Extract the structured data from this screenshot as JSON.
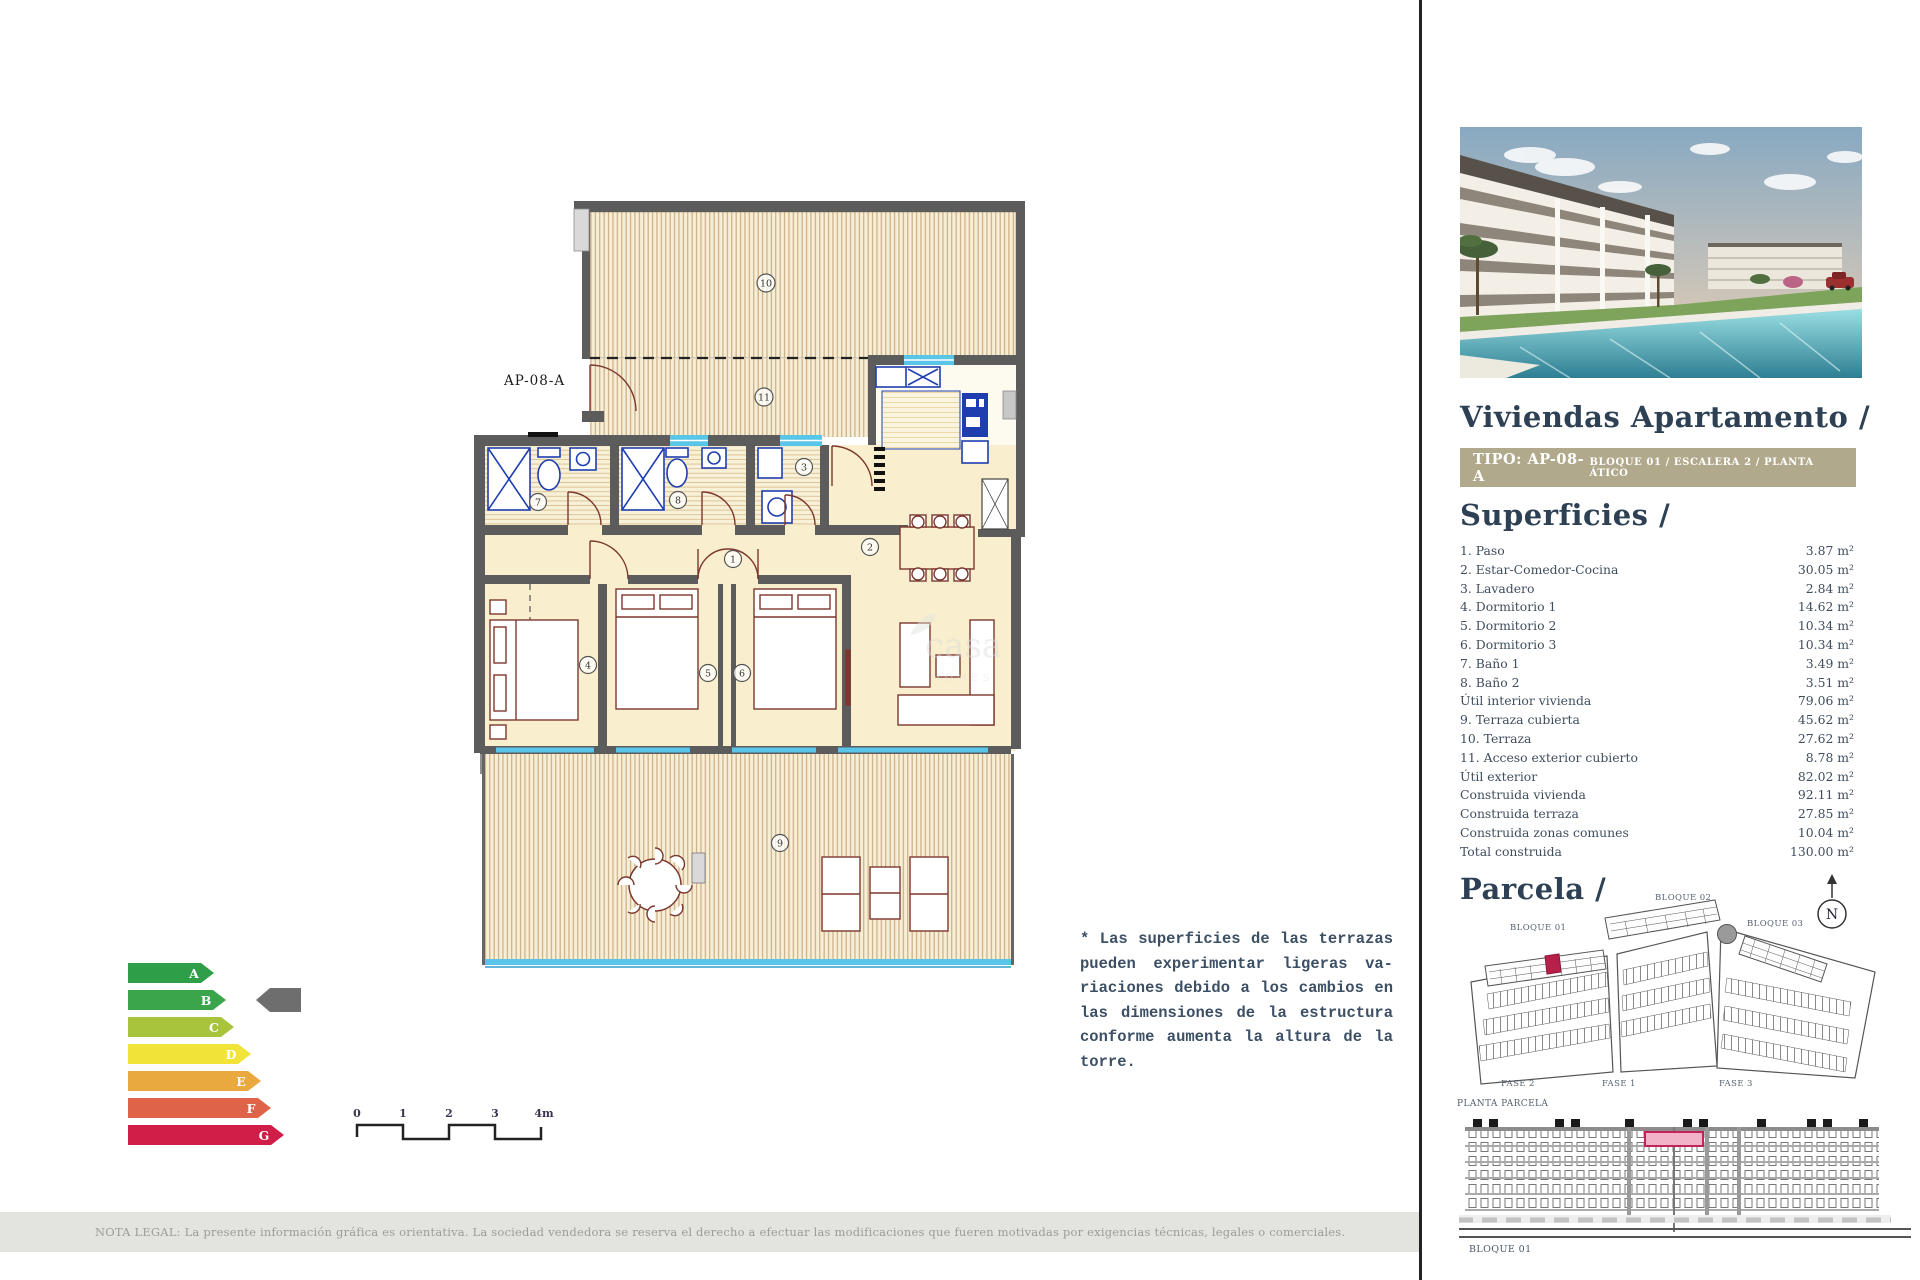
{
  "plan": {
    "unit_label": "AP-08-A",
    "numbers": [
      "1",
      "2",
      "3",
      "4",
      "5",
      "6",
      "7",
      "8",
      "9",
      "10",
      "11"
    ],
    "watermark": {
      "line1": "casa",
      "line2": "HOMES"
    }
  },
  "energy": {
    "grades": [
      "A",
      "B",
      "C",
      "D",
      "E",
      "F",
      "G"
    ],
    "colors": [
      "#2f9e48",
      "#3aa54b",
      "#a8c43c",
      "#f1e338",
      "#eaa93f",
      "#de6349",
      "#d01e48"
    ],
    "active_grade": "B",
    "indicator_color": "#6e6e6e"
  },
  "scalebar": {
    "ticks": [
      "0",
      "1",
      "2",
      "3",
      "4m"
    ]
  },
  "note": {
    "lines": [
      "* Las superficies de las terrazas",
      "pueden experimentar ligeras va-",
      "riaciones debido a los cambios en",
      "las dimensiones de la estructura",
      "conforme aumenta la altura de la",
      "torre."
    ]
  },
  "legal": {
    "text": "NOTA LEGAL: La presente información gráfica es orientativa. La sociedad vendedora se reserva el derecho a efectuar las modificaciones que fueren motivadas por exigencias técnicas, legales o comerciales."
  },
  "panel": {
    "title": "Viviendas Apartamento /",
    "banner": {
      "type": "TIPO: AP-08-A",
      "location": "BLOQUE 01  / ESCALERA 2 / PLANTA ÁTICO"
    },
    "superficies": {
      "title": "Superficies /",
      "rows": [
        {
          "label": "1. Paso",
          "value": "3.87 m²"
        },
        {
          "label": "2. Estar-Comedor-Cocina",
          "value": "30.05 m²"
        },
        {
          "label": "3. Lavadero",
          "value": "2.84 m²"
        },
        {
          "label": "4. Dormitorio 1",
          "value": "14.62 m²"
        },
        {
          "label": "5. Dormitorio 2",
          "value": "10.34 m²"
        },
        {
          "label": "6. Dormitorio 3",
          "value": "10.34 m²"
        },
        {
          "label": "7. Baño 1",
          "value": "3.49 m²"
        },
        {
          "label": "8. Baño 2",
          "value": "3.51 m²"
        },
        {
          "label": "Útil interior vivienda",
          "value": "79.06 m²"
        },
        {
          "label": "9. Terraza cubierta",
          "value": "45.62 m²"
        },
        {
          "label": "10. Terraza",
          "value": "27.62 m²"
        },
        {
          "label": "11. Acceso exterior cubierto",
          "value": "8.78 m²"
        },
        {
          "label": "Útil exterior",
          "value": "82.02 m²"
        },
        {
          "label": "Construida vivienda",
          "value": "92.11 m²"
        },
        {
          "label": "Construida terraza",
          "value": "27.85 m²"
        },
        {
          "label": "Construida zonas comunes",
          "value": "10.04 m²"
        },
        {
          "label": "Total construida",
          "value": "130.00 m²"
        }
      ]
    },
    "parcela": {
      "title": "Parcela /",
      "bloque1": "BLOQUE 01",
      "bloque2": "BLOQUE 02",
      "bloque3": "BLOQUE 03",
      "fase1": "FASE 1",
      "fase2": "FASE 2",
      "fase3": "FASE 3",
      "caption": "PLANTA PARCELA",
      "north": "N"
    },
    "elevation": {
      "caption": "BLOQUE 01"
    }
  }
}
